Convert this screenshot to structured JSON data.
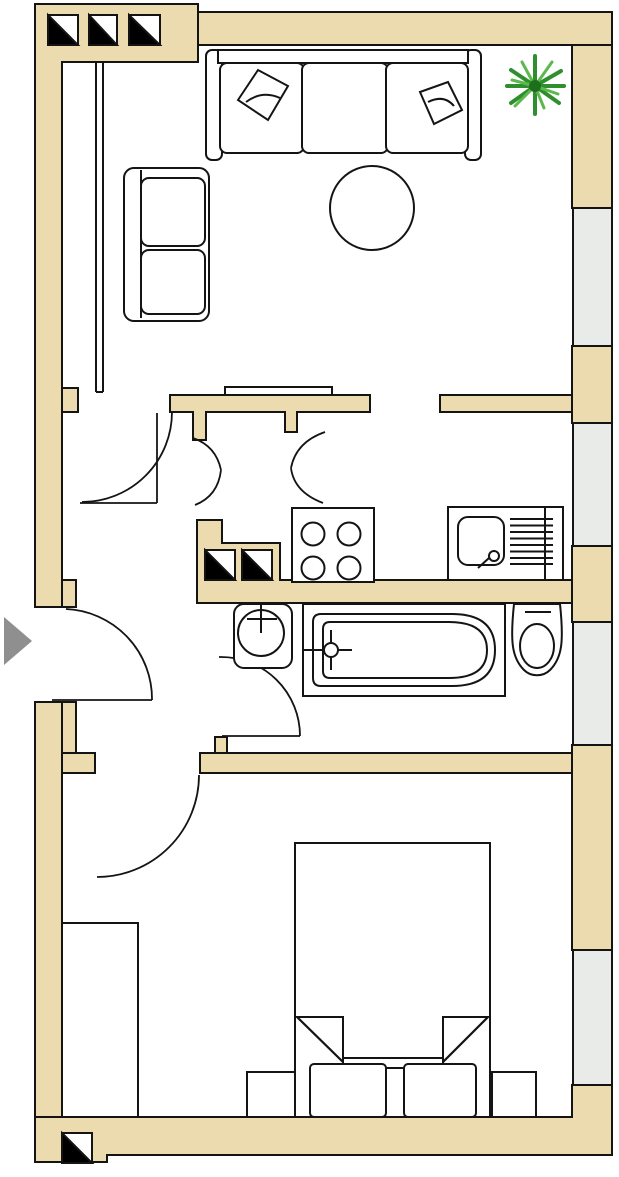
{
  "meta": {
    "title": "Apartment floor plan",
    "description": "Top-view architectural floor plan with living room, hall, kitchen, bathroom and bedroom"
  },
  "palette": {
    "wall_fill": "#eddbb0",
    "outline": "#141414",
    "floor": "#ffffff",
    "window_glass": "#e9ebe8",
    "entry_arrow": "#8f8f8f",
    "plant_dark": "#1d6f1d",
    "plant_mid": "#2f8f2f",
    "plant_light": "#5cb94c",
    "shaft_black": "#000000"
  },
  "rooms": [
    {
      "name": "living-room",
      "furniture": [
        "three-seat-sofa",
        "two-seat-sofa",
        "round-table",
        "potted-plant",
        "wall-cupboard"
      ]
    },
    {
      "name": "hall",
      "furniture": []
    },
    {
      "name": "kitchen",
      "furniture": [
        "stove-4-burners",
        "sink-with-drainboard"
      ]
    },
    {
      "name": "bathroom",
      "furniture": [
        "wash-basin",
        "bathtub",
        "toilet"
      ]
    },
    {
      "name": "bedroom",
      "furniture": [
        "double-bed",
        "pillow-left",
        "pillow-right",
        "nightstand-left",
        "nightstand-right",
        "wardrobe"
      ]
    }
  ],
  "windows": [
    {
      "name": "living-room-window",
      "side": "right"
    },
    {
      "name": "kitchen-window",
      "side": "right"
    },
    {
      "name": "bathroom-window",
      "side": "right"
    },
    {
      "name": "bedroom-window",
      "side": "right"
    }
  ],
  "doors": [
    {
      "name": "entrance-door",
      "type": "swing",
      "location": "left-wall"
    },
    {
      "name": "living-room-door",
      "type": "swing",
      "location": "hall"
    },
    {
      "name": "hall-double-swing-door",
      "type": "double-swing",
      "location": "hall"
    },
    {
      "name": "bathroom-door",
      "type": "swing",
      "location": "bathroom"
    },
    {
      "name": "bedroom-door",
      "type": "swing",
      "location": "bedroom"
    }
  ],
  "symbols": {
    "shaft_marker_count": 6,
    "shaft_marker_groups": [
      "3 top-left wall",
      "2 kitchen wall",
      "1 bottom-left wall"
    ],
    "entry_arrow_direction": "right"
  }
}
